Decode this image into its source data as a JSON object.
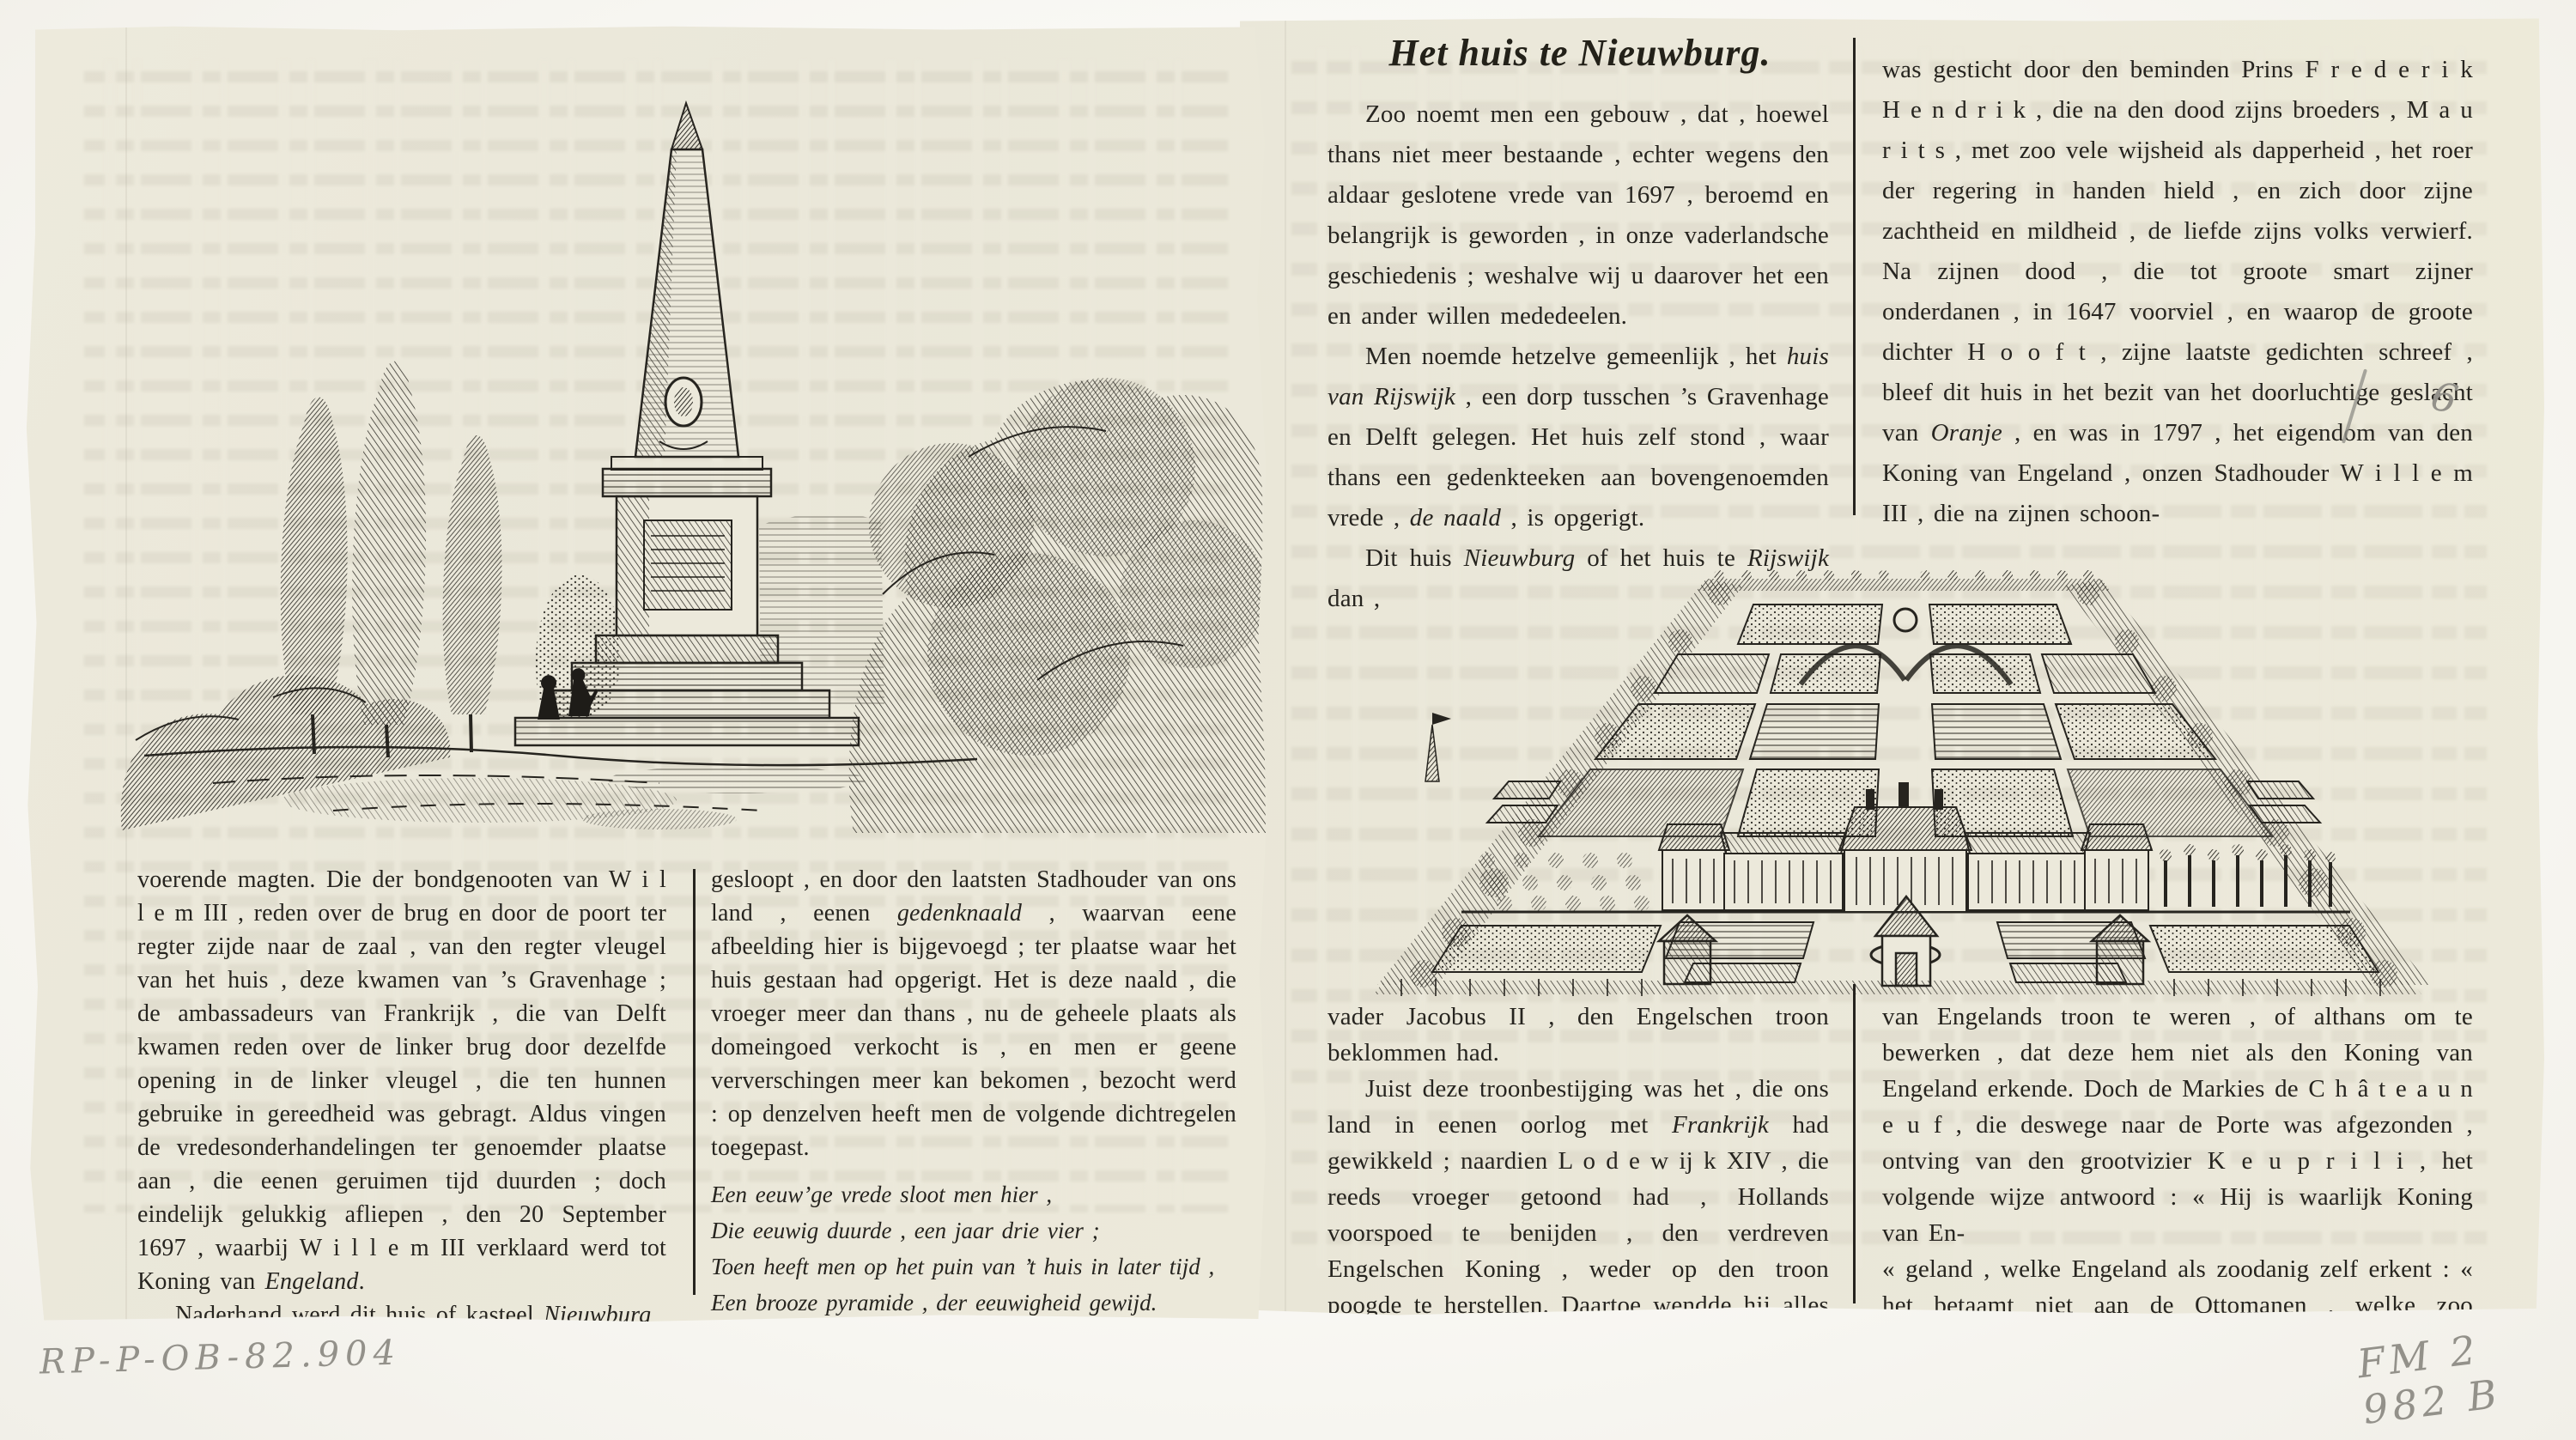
{
  "left_page": {
    "engraving": {
      "name": "memorial-obelisk-engraving",
      "description": "Engraving of the memorial needle (gedenknaald) between poplars and trees"
    },
    "col1": {
      "paragraphs": [
        "voerende magten. Die der bondgenooten van W i l l e m III , reden over de brug en door de poort ter regter zijde naar de zaal , van den regter vleugel van het huis , deze kwamen van ’s Gravenhage ; de ambassadeurs van Frankrijk , die van Delft kwamen reden over de linker brug door dezelfde opening in de linker vleugel , die ten hunnen gebruike in gereedheid was gebragt. Aldus vingen de vredesonderhandelingen ter genoemder plaatse aan , die eenen geruimen tijd duurden ; doch eindelijk gelukkig afliepen , den 20 September 1697 , waarbij W i l l e m III verklaard werd tot Koning van <i>Engeland</i>.",
        "Naderhand werd dit huis of kasteel <i>Nieuwburg</i>"
      ]
    },
    "col2": {
      "paragraph": "gesloopt , en door den laatsten Stadhouder van ons land , eenen <i>gedenknaald</i> , waarvan eene afbeelding hier is bijgevoegd ; ter plaatse waar het huis gestaan had opgerigt. Het is deze naald , die vroeger meer dan thans , nu de geheele plaats als domeingoed verkocht is , en men er geene ververschingen meer kan bekomen , bezocht werd : op denzelven heeft men de volgende dichtregelen toegepast.",
      "verse": [
        "Een eeuw’ge vrede sloot men hier ,",
        "Die eeuwig duurde , een jaar drie vier ;",
        "Toen heeft men op het puin van ’t huis in later tijd ,",
        "Een brooze pyramide , der eeuwigheid gewijd."
      ]
    }
  },
  "right_page": {
    "title": "Het huis te Nieuwburg.",
    "top": {
      "col1": {
        "paragraphs": [
          "Zoo noemt men een gebouw , dat , hoewel thans niet meer bestaande , echter wegens den aldaar geslotene vrede van 1697 , beroemd en belangrijk is geworden , in onze vaderlandsche geschiedenis ; weshalve wij u daarover het een en ander willen mededeelen.",
          "Men noemde hetzelve gemeenlijk , het <i>huis van Rijswijk</i> , een dorp tusschen ’s Gravenhage en Delft gelegen. Het huis zelf stond , waar thans een gedenkteeken aan bovengenoemden vrede , <i>de naald</i> , is opgerigt.",
          "Dit huis <i>Nieuwburg</i> of het huis te <i>Rijswijk</i> dan ,"
        ]
      },
      "col2": {
        "paragraphs": [
          "was gesticht door den beminden Prins F r e d e r i k H e n d r i k , die na den dood zijns broeders , M a u r i t s , met zoo vele wijsheid als dapperheid , het roer der regering in handen hield , en zich door zijne zachtheid en mildheid , de liefde zijns volks verwierf. Na zijnen dood , die tot groote smart zijner onderdanen , in 1647 voorviel , en waarop de groote dichter H o o f t , zijne laatste gedichten schreef , bleef dit huis in het bezit van het doorluchtige geslacht van <i>Oranje</i> , en was in 1797 , het eigendom van den Koning van Engeland , onzen Stadhouder W i l l e m III , die na zijnen schoon-"
        ]
      }
    },
    "engraving": {
      "name": "garden-birdseye-engraving",
      "description": "Bird's-eye view of the Huis te Nieuwburg with formal parterre gardens"
    },
    "bottom": {
      "col1": {
        "paragraphs": [
          "vader Jacobus II , den Engelschen troon beklommen had.",
          "Juist deze troonbestijging was het , die ons land in eenen oorlog met <i>Frankrijk</i> had gewikkeld ; naardien L o d e w ij k XIV , die reeds vroeger getoond had , Hollands voorspoed te benijden , den verdreven Engelschen Koning , weder op den troon poogde te herstellen. Daartoe wendde hij alles aan , tot zelfs bij den grooten Heer , om onzen Stadhouder"
        ]
      },
      "col2": {
        "paragraphs": [
          "van Engelands troon te weren , of althans om te bewerken , dat deze hem niet als den Koning van Engeland erkende. Doch de Markies de C h â t e a u n e u f , die deswege naar de Porte was afgezonden , ontving van den grootvizier K e u p r i l i , het volgende wijze antwoord : « Hij is waarlijk Koning van En-",
          "« geland , welke Engeland als zoodanig zelf erkent : « het betaamt niet aan de Ottomanen , welke zoo dikwijls hunnen Sultan verdreven hebben , om een an-"
        ]
      }
    }
  },
  "handwritten": {
    "bottom_left": "RP-P-OB-82.904",
    "bottom_right": "FM 2 982 B",
    "margin_digit": "6"
  },
  "colors": {
    "paper": "#ebe8da",
    "ink": "#26241f",
    "pencil": "#93918a",
    "backing": "#f7f6f1"
  }
}
